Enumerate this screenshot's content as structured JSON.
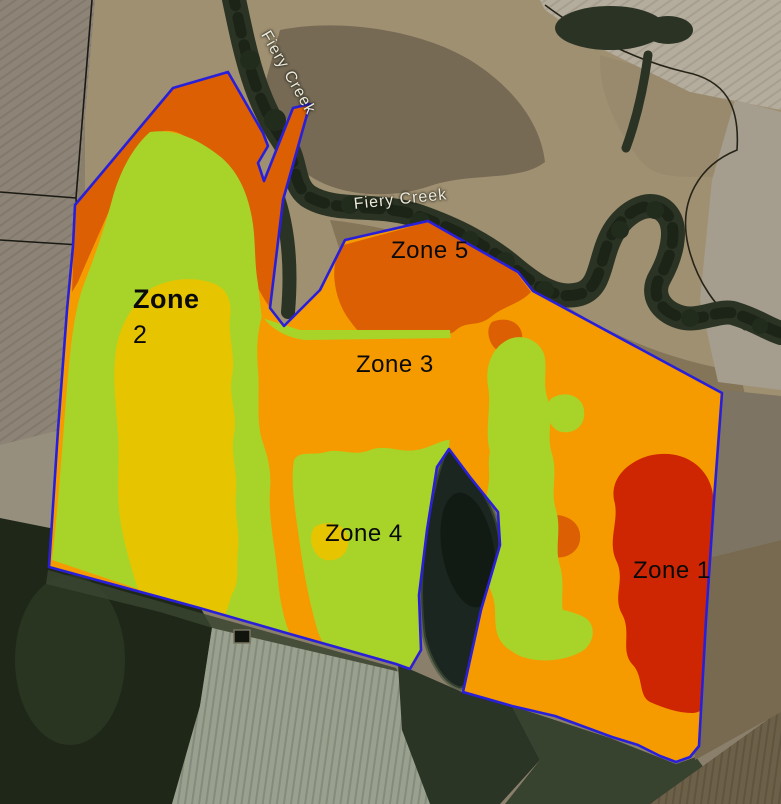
{
  "map": {
    "creek_label_vertical": "Fiery Creek",
    "creek_label_horizontal": "Fiery Creek",
    "zones": [
      {
        "id": "zone-1",
        "label": "Zone 1",
        "color": "#CE2503"
      },
      {
        "id": "zone-2",
        "label_line1": "Zone",
        "label_line2": "2",
        "color": "#E6C400"
      },
      {
        "id": "zone-3",
        "label": "Zone 3",
        "color": "#F59B00"
      },
      {
        "id": "zone-4",
        "label": "Zone 4",
        "color": "#A8D429"
      },
      {
        "id": "zone-5",
        "label": "Zone 5",
        "color": "#DC5F04"
      }
    ],
    "colors": {
      "boundary_blue": "#2A1FD9",
      "zone_red": "#CE2503",
      "zone_dark_orange": "#DC5F04",
      "zone_orange": "#F59B00",
      "zone_green": "#A8D429",
      "zone_yellow": "#E6C400",
      "label_text": "#0a0a0a",
      "creek_text": "#ECE8DB"
    }
  }
}
